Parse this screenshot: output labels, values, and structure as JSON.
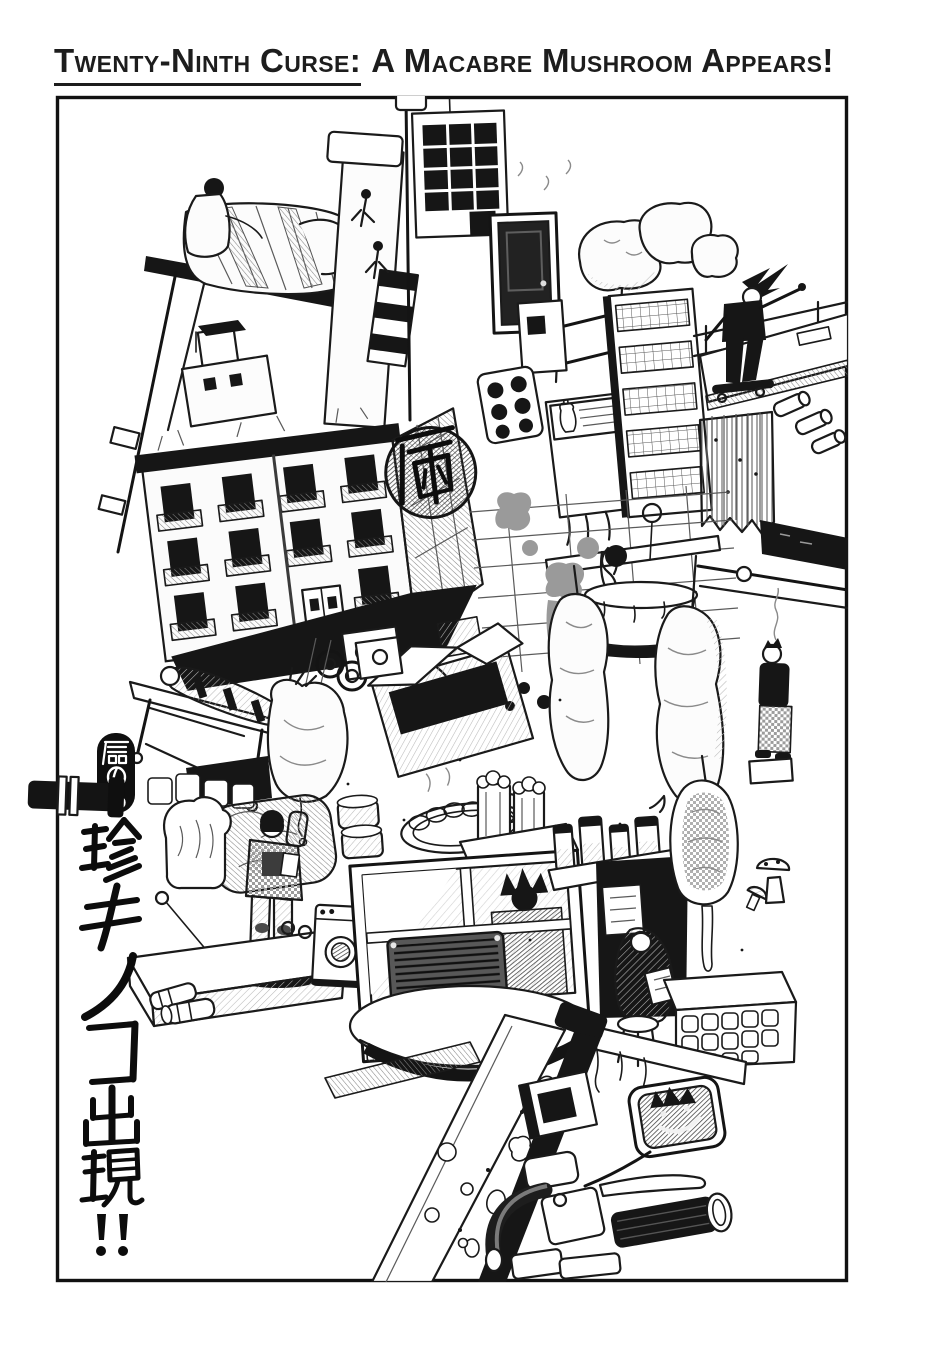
{
  "header": {
    "title_part1": "Twenty-Ninth Curse:",
    "title_part2": "A Macabre Mushroom Appears!"
  },
  "artwork": {
    "chapter_badge": "魔の29",
    "chapter_badge_number": "29",
    "side_title": "珍キノコ出現!!",
    "hospital_sign": "病",
    "alt": "Black-and-white manga collage of a floating junk city: stacked tenement buildings with a 病 graffito, a chimney, a skateboarder on a plank, hanging carcasses and meat, a stretcher, bread and gyoza, a gas-masked figure, machinery, and a motorbike handlebar with a mirror."
  },
  "colors": {
    "ink": "#1a1a1a",
    "paper": "#ffffff"
  }
}
